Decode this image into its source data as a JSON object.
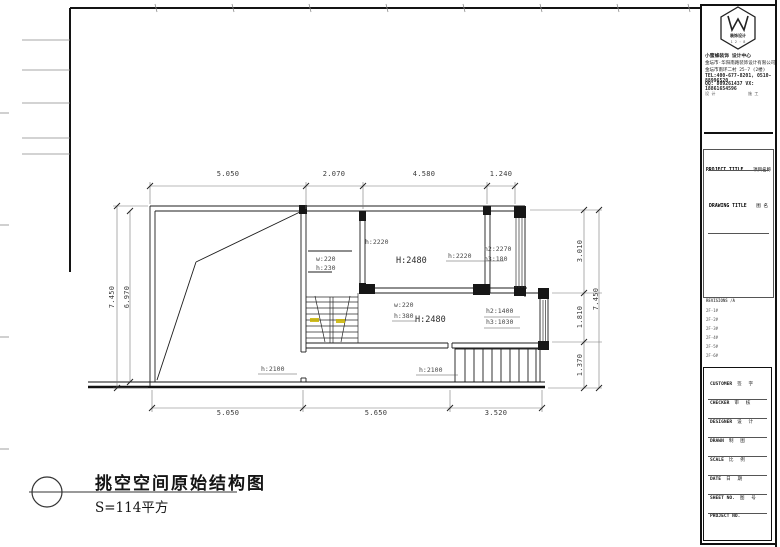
{
  "plan": {
    "dims_top": [
      "5.050",
      "2.070",
      "4.580",
      "1.240"
    ],
    "dims_bottom": [
      "5.050",
      "5.650",
      "3.520"
    ],
    "dim_left_outer": "7.450",
    "dim_left_inner": "6.970",
    "dims_right": [
      "3.010",
      "1.810",
      "1.370"
    ],
    "dim_right_outer": "7.450",
    "rooms": {
      "mid_upper_w": "w:220",
      "mid_upper_h": "h:230",
      "hall_h_left": "h:2220",
      "hall_height": "H:2480",
      "hall_h_right": "h:2220",
      "right_room_h2": "h2:2270",
      "right_room_h3": "h3:180",
      "lower_w": "w:220",
      "lower_h": "h:380",
      "lower_height": "H:2480",
      "bay_h2": "h2:1400",
      "bay_h3": "h3:1030",
      "door_left_h": "h:2100",
      "door_mid_h": "h:2100"
    },
    "highlight_color": "#c9b400"
  },
  "caption": {
    "title": "挑空空间原始结构图",
    "area": "S=114平方"
  },
  "titleblock": {
    "logo": {
      "name": "装饰设计",
      "sub": "1 2 · 8"
    },
    "company": {
      "line1": "小蜜蜂装饰 设计中心",
      "line2": "金坛市·华阳南路装饰设计有限公司",
      "line3": "金坛市南环二村 25-7 (2楼)",
      "tel": "TEL:400-677-8201, 0510-88996520",
      "qq": "QQ: 809261437   VX: 18861654596",
      "foot_left": "设 计",
      "foot_right": "施 工"
    },
    "project_title_label": "PROJECT TITLE",
    "project_title_value": "项目名称",
    "drawing_title_label": "DRAWING TITLE",
    "drawing_title_value": "图 名",
    "revisions": [
      "REVISIONS  /A",
      "2F-1#",
      "2F-2#",
      "2F-3#",
      "2F-4#",
      "2F-5#",
      "2F-6#"
    ],
    "fields": [
      {
        "label": "CUSTOMER",
        "value": "签 字"
      },
      {
        "label": "CHECKER",
        "value": "审 核"
      },
      {
        "label": "DESIGNER",
        "value": "设 计"
      },
      {
        "label": "DRAWN",
        "value": "制 图"
      },
      {
        "label": "SCALE",
        "value": "比 例"
      },
      {
        "label": "DATE",
        "value": "日 期"
      },
      {
        "label": "SHEET NO.",
        "value": "图 号"
      },
      {
        "label": "PROJECT NO.",
        "value": ""
      }
    ]
  }
}
